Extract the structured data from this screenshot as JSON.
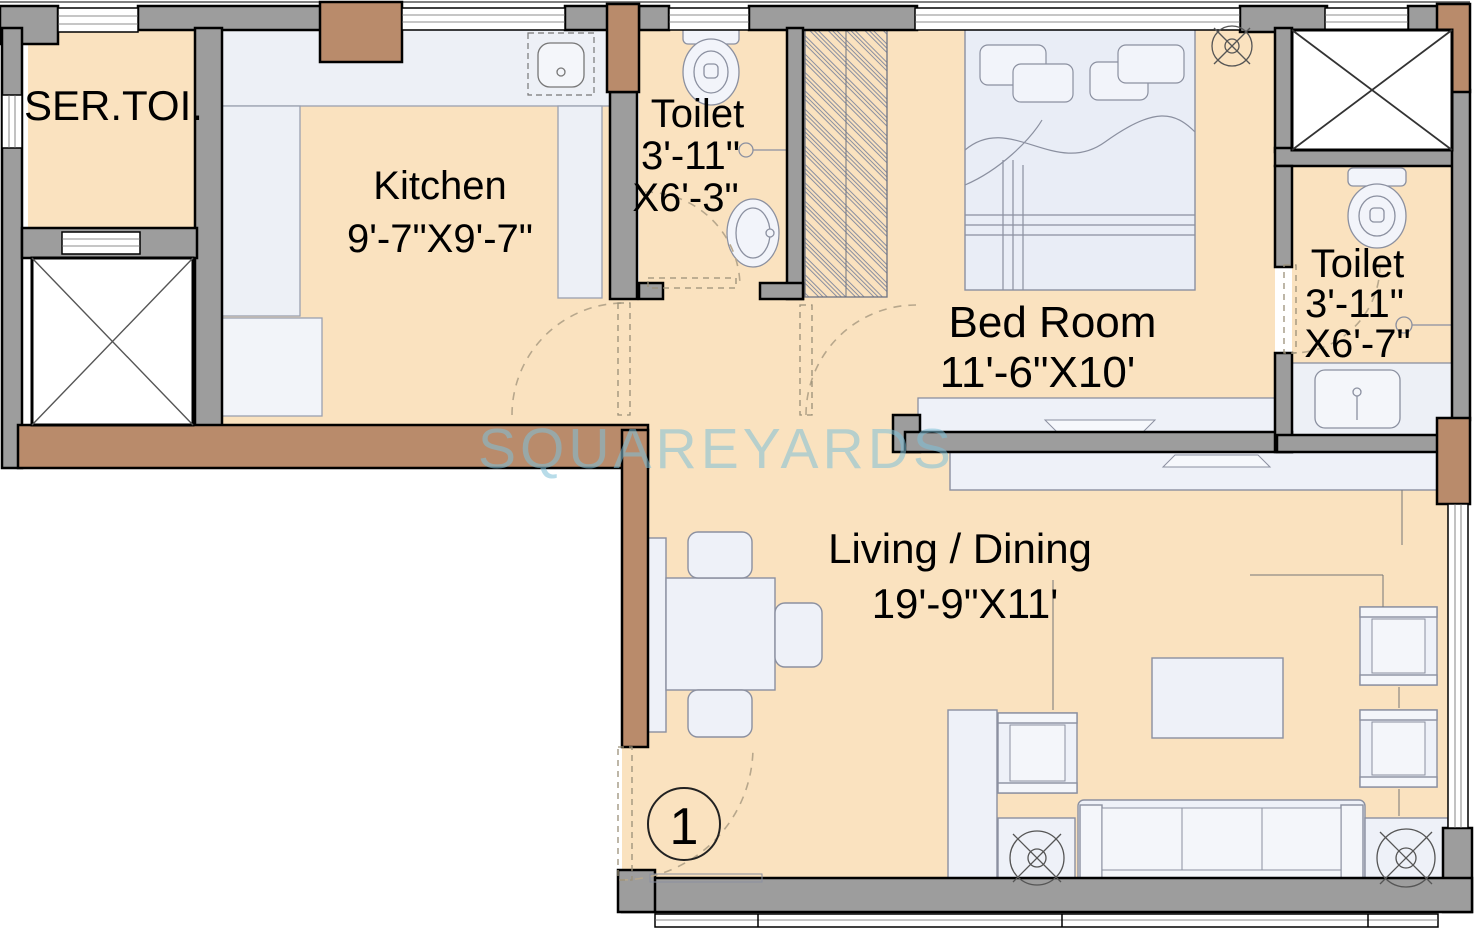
{
  "watermark": "SQUAREYARDS",
  "unit_marker": "1",
  "rooms": {
    "service_toilet": {
      "name": "SER.TOI."
    },
    "kitchen": {
      "name": "Kitchen",
      "dimensions": "9'-7\"X9'-7\""
    },
    "toilet_top": {
      "name": "Toilet",
      "dim_line1": "3'-11\"",
      "dim_line2": "X6'-3\""
    },
    "bedroom": {
      "name": "Bed Room",
      "dimensions": "11'-6\"X10'"
    },
    "toilet_right": {
      "name": "Toilet",
      "dim_line1": "3'-11\"",
      "dim_line2": "X6'-7\""
    },
    "living_dining": {
      "name": "Living / Dining",
      "dimensions": "19'-9\"X11'"
    }
  },
  "colors": {
    "floor": "#fae2bf",
    "wall_gray": "#9d9d9d",
    "wood_brown": "#b98b6b",
    "furniture": "#eef1f8",
    "watermark_blue": "#7fc0d8"
  }
}
